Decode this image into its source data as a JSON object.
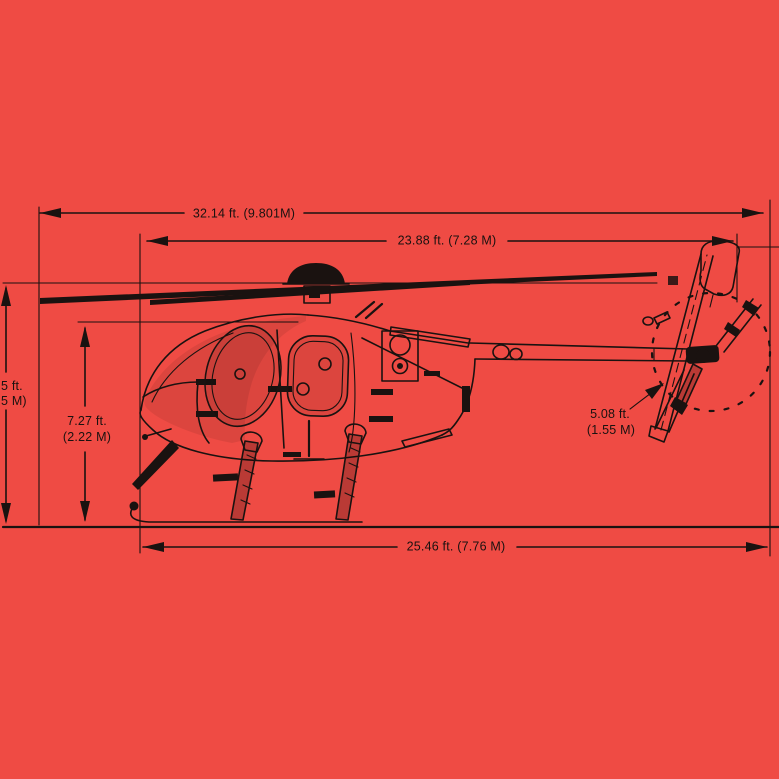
{
  "title": "Helicopter dimension drawing (side profile)",
  "colors": {
    "background": "#EF4B44",
    "ink": "#1A1210"
  },
  "dimensions": {
    "overall_length": "32.14 ft. (9.801M)",
    "rotor_to_tail": "23.88 ft. (7.28 M)",
    "skid_length": "25.46 ft. (7.76 M)",
    "cabin_height_ft": "7.27 ft.",
    "cabin_height_m": "(2.22 M)",
    "tail_rotor_ft": "5.08 ft.",
    "tail_rotor_m": "(1.55 M)",
    "overall_height_ft_clipped": "5 ft.",
    "overall_height_m_clipped": "5 M)"
  }
}
